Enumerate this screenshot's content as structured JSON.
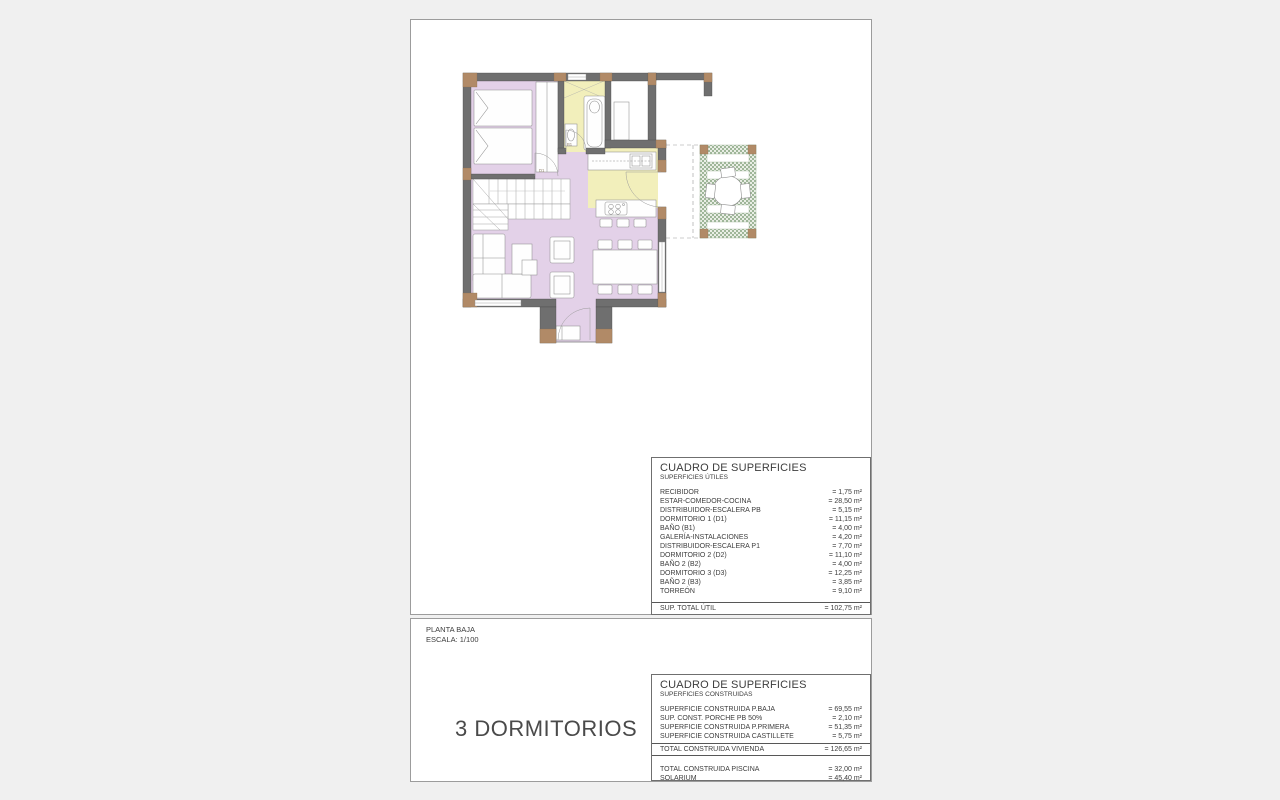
{
  "background": "#f0f0f0",
  "floor_plan": {
    "labels": {
      "bathroom": "B1",
      "bedroom_door": "D1"
    },
    "colors": {
      "room_floor": "#e3d1e8",
      "wet_floor": "#f2efbb",
      "wall": "#6f6f6f",
      "wall_accent": "#b18a67",
      "pergola_green": "#9fb699"
    }
  },
  "title_block": {
    "plan_name": "PLANTA BAJA",
    "scale": "ESCALA: 1/100"
  },
  "caption": "3 DORMITORIOS",
  "surface_tables": {
    "utiles": {
      "title": "CUADRO DE SUPERFICIES",
      "subtitle": "SUPERFICIES ÚTILES",
      "rows": [
        {
          "label": "RECIBIDOR",
          "value": "= 1,75 m²"
        },
        {
          "label": "ESTAR-COMEDOR-COCINA",
          "value": "= 28,50 m²"
        },
        {
          "label": "DISTRIBUIDOR-ESCALERA PB",
          "value": "= 5,15 m²"
        },
        {
          "label": "DORMITORIO 1 (D1)",
          "value": "= 11,15 m²"
        },
        {
          "label": "BAÑO (B1)",
          "value": "= 4,00 m²"
        },
        {
          "label": "GALERÍA-INSTALACIONES",
          "value": "= 4,20 m²"
        },
        {
          "label": "DISTRIBUIDOR-ESCALERA P1",
          "value": "= 7,70 m²"
        },
        {
          "label": "DORMITORIO 2 (D2)",
          "value": "= 11,10 m²"
        },
        {
          "label": "BAÑO 2 (B2)",
          "value": "= 4,00 m²"
        },
        {
          "label": "DORMITORIO 3 (D3)",
          "value": "= 12,25 m²"
        },
        {
          "label": "BAÑO 2 (B3)",
          "value": "= 3,85 m²"
        },
        {
          "label": "TORREÓN",
          "value": "= 9,10 m²"
        }
      ],
      "total": {
        "label": "SUP. TOTAL ÚTIL",
        "value": "= 102,75 m²"
      }
    },
    "construidas": {
      "title": "CUADRO DE SUPERFICIES",
      "subtitle": "SUPERFICIES CONSTRUIDAS",
      "rows": [
        {
          "label": "SUPERFICIE CONSTRUIDA P.BAJA",
          "value": "= 69,55 m²"
        },
        {
          "label": "SUP. CONST. PORCHE PB 50%",
          "value": "= 2,10 m²"
        },
        {
          "label": "SUPERFICIE CONSTRUIDA P.PRIMERA",
          "value": "= 51,35 m²"
        },
        {
          "label": "SUPERFICIE CONSTRUIDA CASTILLETE",
          "value": "= 5,75 m²"
        }
      ],
      "total": {
        "label": "TOTAL CONSTRUIDA VIVIENDA",
        "value": "= 126,65 m²"
      },
      "extra_rows": [
        {
          "label": "TOTAL CONSTRUIDA PISCINA",
          "value": "= 32,00 m²"
        },
        {
          "label": "SOLARIUM",
          "value": "= 45,40 m²"
        }
      ]
    }
  }
}
